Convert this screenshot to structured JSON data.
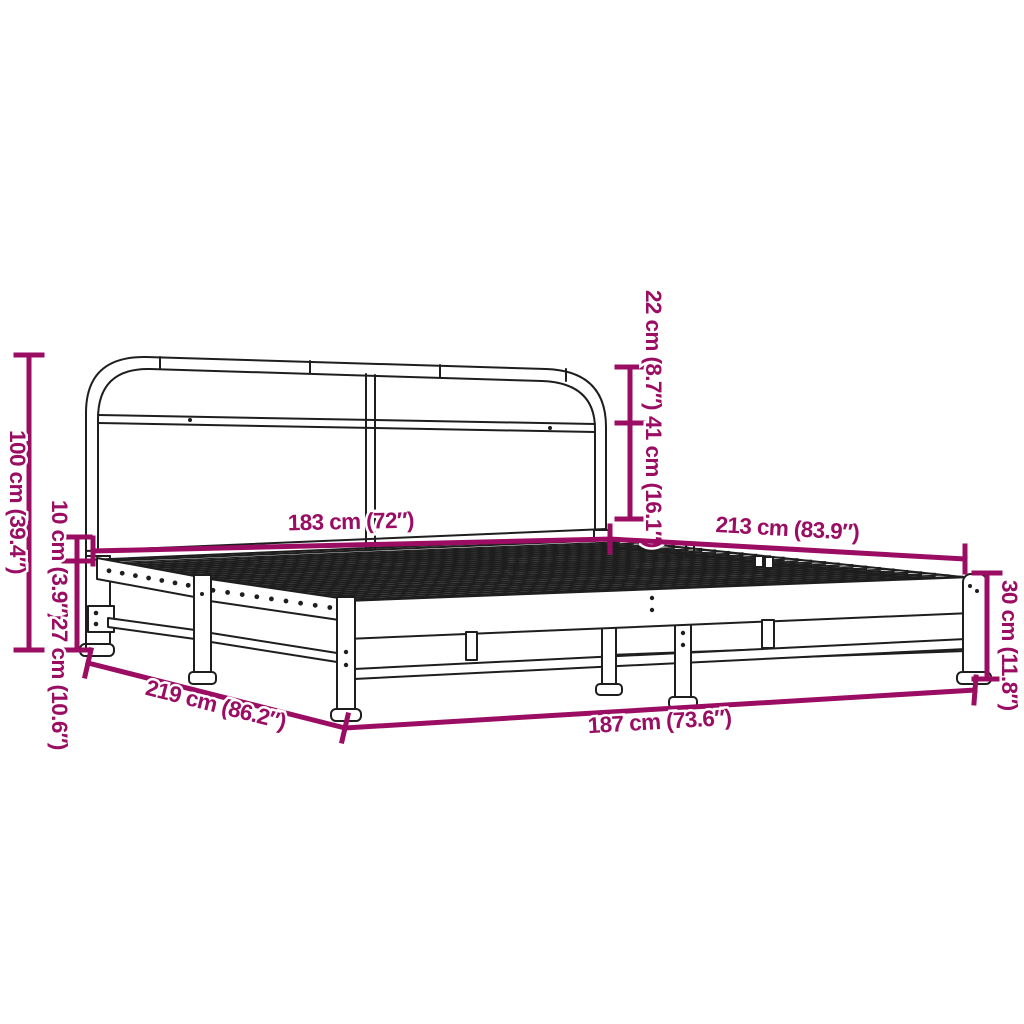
{
  "page": {
    "background": "#ffffff",
    "subject": "metal bed frame without mattress - dimension diagram"
  },
  "colors": {
    "dimension_accent": "#9a0d63",
    "drawing_line": "#1e1e1e"
  },
  "diagram": {
    "dimensions": {
      "total_height": "100 cm (39.4″)",
      "upper_clearance": "10 cm (3.9″)",
      "under_bed_clearance": "27 cm (10.6″)",
      "headboard_top_section": "22 cm (8.7″)",
      "headboard_lower_section": "41 cm (16.1″)",
      "inner_width": "183 cm (72″)",
      "inner_length": "213 cm (83.9″)",
      "side_height": "30 cm (11.8″)",
      "outer_length": "219 cm (86.2″)",
      "outer_width": "187 cm (73.6″)"
    }
  }
}
